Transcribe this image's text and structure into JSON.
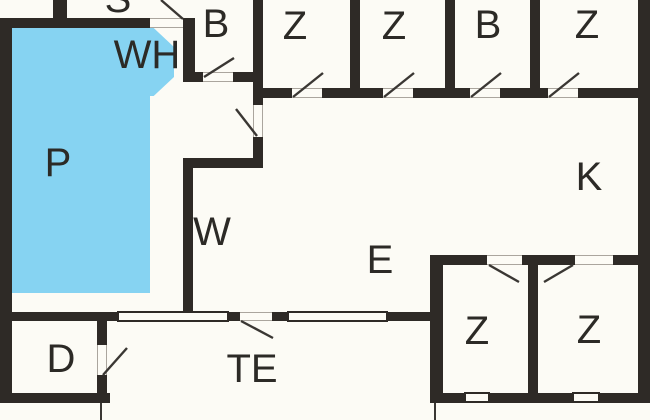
{
  "floorplan": {
    "canvas": {
      "width": 650,
      "height": 420
    },
    "colors": {
      "wall": "#2e2a26",
      "floor": "#fcfbf5",
      "pool": "#86d3f2",
      "label": "#2c2a26",
      "swing": "#3a3733",
      "opening_line": "#aaa59d",
      "window_border": "#2e2a26"
    },
    "rooms": [
      {
        "id": "s",
        "label": "S",
        "x": 118,
        "y": -1
      },
      {
        "id": "wh",
        "label": "WH",
        "x": 147,
        "y": 55
      },
      {
        "id": "b1",
        "label": "B",
        "x": 216,
        "y": 24
      },
      {
        "id": "z1",
        "label": "Z",
        "x": 295,
        "y": 26
      },
      {
        "id": "z2",
        "label": "Z",
        "x": 394,
        "y": 26
      },
      {
        "id": "b2",
        "label": "B",
        "x": 488,
        "y": 25
      },
      {
        "id": "z3",
        "label": "Z",
        "x": 587,
        "y": 25
      },
      {
        "id": "p",
        "label": "P",
        "x": 58,
        "y": 163
      },
      {
        "id": "k",
        "label": "K",
        "x": 589,
        "y": 177
      },
      {
        "id": "w",
        "label": "W",
        "x": 212,
        "y": 232
      },
      {
        "id": "e",
        "label": "E",
        "x": 380,
        "y": 260
      },
      {
        "id": "te",
        "label": "TE",
        "x": 252,
        "y": 369
      },
      {
        "id": "d",
        "label": "D",
        "x": 61,
        "y": 359
      },
      {
        "id": "z4",
        "label": "Z",
        "x": 477,
        "y": 331
      },
      {
        "id": "z5",
        "label": "Z",
        "x": 589,
        "y": 330
      }
    ],
    "pool": {
      "rect": {
        "x": 10,
        "y": 28,
        "w": 140,
        "h": 265
      },
      "octagon": {
        "x": 104,
        "y": 28,
        "w": 70,
        "h": 68
      }
    },
    "walls": [
      {
        "x": 0,
        "y": 18,
        "w": 12,
        "h": 385
      },
      {
        "x": 0,
        "y": 18,
        "w": 150,
        "h": 10
      },
      {
        "x": 53,
        "y": 0,
        "w": 14,
        "h": 28
      },
      {
        "x": 183,
        "y": 18,
        "w": 12,
        "h": 64
      },
      {
        "x": 183,
        "y": 72,
        "w": 20,
        "h": 10
      },
      {
        "x": 233,
        "y": 72,
        "w": 30,
        "h": 10
      },
      {
        "x": 253,
        "y": 0,
        "w": 10,
        "h": 105
      },
      {
        "x": 350,
        "y": 0,
        "w": 10,
        "h": 98
      },
      {
        "x": 445,
        "y": 0,
        "w": 10,
        "h": 98
      },
      {
        "x": 530,
        "y": 0,
        "w": 10,
        "h": 98
      },
      {
        "x": 253,
        "y": 88,
        "w": 39,
        "h": 10
      },
      {
        "x": 322,
        "y": 88,
        "w": 61,
        "h": 10
      },
      {
        "x": 413,
        "y": 88,
        "w": 57,
        "h": 10
      },
      {
        "x": 500,
        "y": 88,
        "w": 48,
        "h": 10
      },
      {
        "x": 578,
        "y": 88,
        "w": 72,
        "h": 10
      },
      {
        "x": 253,
        "y": 137,
        "w": 10,
        "h": 31
      },
      {
        "x": 183,
        "y": 158,
        "w": 80,
        "h": 10
      },
      {
        "x": 183,
        "y": 158,
        "w": 10,
        "h": 154
      },
      {
        "x": 0,
        "y": 312,
        "w": 117,
        "h": 9
      },
      {
        "x": 229,
        "y": 312,
        "w": 11,
        "h": 9
      },
      {
        "x": 272,
        "y": 312,
        "w": 15,
        "h": 9
      },
      {
        "x": 388,
        "y": 312,
        "w": 55,
        "h": 9
      },
      {
        "x": 97,
        "y": 312,
        "w": 10,
        "h": 33
      },
      {
        "x": 97,
        "y": 375,
        "w": 10,
        "h": 28
      },
      {
        "x": 0,
        "y": 393,
        "w": 110,
        "h": 10
      },
      {
        "x": 638,
        "y": 0,
        "w": 12,
        "h": 403
      },
      {
        "x": 430,
        "y": 255,
        "w": 13,
        "h": 148
      },
      {
        "x": 430,
        "y": 255,
        "w": 57,
        "h": 10
      },
      {
        "x": 522,
        "y": 255,
        "w": 53,
        "h": 10
      },
      {
        "x": 613,
        "y": 255,
        "w": 37,
        "h": 10
      },
      {
        "x": 528,
        "y": 265,
        "w": 10,
        "h": 128
      },
      {
        "x": 430,
        "y": 393,
        "w": 220,
        "h": 10
      }
    ],
    "openings": [
      {
        "x": 150,
        "y": 18,
        "w": 33,
        "h": 10
      },
      {
        "x": 203,
        "y": 72,
        "w": 30,
        "h": 10
      },
      {
        "x": 292,
        "y": 88,
        "w": 30,
        "h": 10
      },
      {
        "x": 383,
        "y": 88,
        "w": 30,
        "h": 10
      },
      {
        "x": 470,
        "y": 88,
        "w": 30,
        "h": 10
      },
      {
        "x": 548,
        "y": 88,
        "w": 30,
        "h": 10
      },
      {
        "x": 253,
        "y": 105,
        "w": 10,
        "h": 32
      },
      {
        "x": 240,
        "y": 312,
        "w": 32,
        "h": 9
      },
      {
        "x": 97,
        "y": 345,
        "w": 10,
        "h": 30
      },
      {
        "x": 487,
        "y": 255,
        "w": 35,
        "h": 10
      },
      {
        "x": 575,
        "y": 255,
        "w": 38,
        "h": 10
      }
    ],
    "windows": [
      {
        "x": 117,
        "y": 311,
        "w": 112,
        "h": 11
      },
      {
        "x": 287,
        "y": 311,
        "w": 101,
        "h": 11
      },
      {
        "x": 464,
        "y": 392,
        "w": 26,
        "h": 11
      },
      {
        "x": 572,
        "y": 392,
        "w": 28,
        "h": 11
      }
    ],
    "door_swings": [
      {
        "x1": 183,
        "y1": 19,
        "x2": 161,
        "y2": 0
      },
      {
        "x1": 204,
        "y1": 77,
        "x2": 234,
        "y2": 58
      },
      {
        "x1": 293,
        "y1": 97,
        "x2": 323,
        "y2": 73
      },
      {
        "x1": 384,
        "y1": 97,
        "x2": 414,
        "y2": 73
      },
      {
        "x1": 471,
        "y1": 97,
        "x2": 501,
        "y2": 73
      },
      {
        "x1": 549,
        "y1": 97,
        "x2": 579,
        "y2": 73
      },
      {
        "x1": 257,
        "y1": 136,
        "x2": 236,
        "y2": 109
      },
      {
        "x1": 241,
        "y1": 321,
        "x2": 273,
        "y2": 338
      },
      {
        "x1": 103,
        "y1": 375,
        "x2": 127,
        "y2": 348
      },
      {
        "x1": 489,
        "y1": 265,
        "x2": 519,
        "y2": 282
      },
      {
        "x1": 573,
        "y1": 265,
        "x2": 544,
        "y2": 282
      }
    ],
    "terrace_lines": [
      {
        "x1": 101,
        "y1": 403,
        "x2": 101,
        "y2": 420
      },
      {
        "x1": 435,
        "y1": 403,
        "x2": 435,
        "y2": 420
      }
    ]
  }
}
